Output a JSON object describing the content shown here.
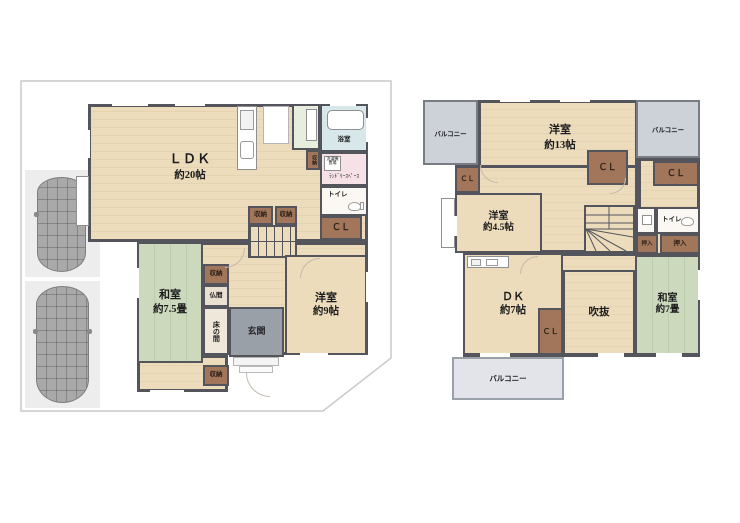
{
  "f1": {
    "ldk_name": "ＬＤＫ",
    "ldk_size": "約20帖",
    "bath": "浴室",
    "washer": "洗濯機置場",
    "laundry": "ﾗﾝﾄﾞﾘｰｽﾍﾟｰｽ",
    "toilet": "トイレ",
    "cl": "ＣＬ",
    "storage": "収納",
    "butsuma": "仏間",
    "tokonoma": "床の間",
    "washitsu_name": "和室",
    "washitsu_size": "約7.5畳",
    "genkan": "玄関",
    "yoshitsu_name": "洋室",
    "yoshitsu_size": "約9帖"
  },
  "f2": {
    "balcony": "バルコニー",
    "room13_name": "洋室",
    "room13_size": "約13帖",
    "room45_name": "洋室",
    "room45_size": "約4.5帖",
    "cl": "ＣＬ",
    "toilet": "トイレ",
    "oshiire": "押入",
    "dk_name": "ＤＫ",
    "dk_size": "約7帖",
    "void": "吹抜",
    "washitsu_name": "和室",
    "washitsu_size": "約7畳"
  },
  "colors": {
    "wall": "#54555c",
    "floor": "#ecdcbb",
    "tatami": "#ccd9bc",
    "storage_brown": "#a1765a",
    "bath_blue": "#d8e8ea",
    "laundry_pink": "#f6e2e6",
    "entrance_gray": "#9aa0a8",
    "balcony_gray": "#cdd2d9"
  }
}
